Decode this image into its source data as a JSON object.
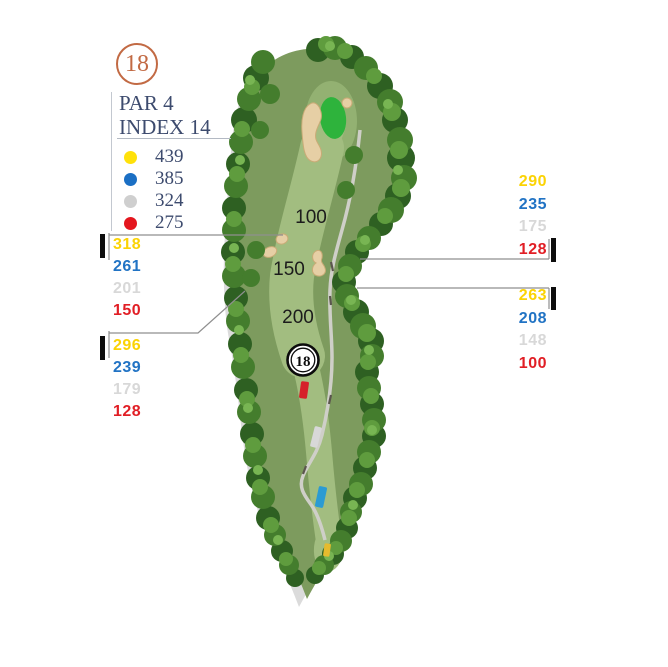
{
  "hole_badge": {
    "number": "18",
    "ring_color": "#c26a44"
  },
  "header": {
    "par_label": "PAR 4",
    "index_label": "INDEX 14",
    "text_color": "#3d4b6e"
  },
  "legend": {
    "rows": [
      {
        "tee": "yellow",
        "color": "#ffe10a",
        "yards": "439"
      },
      {
        "tee": "blue",
        "color": "#1b6fc4",
        "yards": "385"
      },
      {
        "tee": "white",
        "color": "#cfcfcf",
        "yards": "324"
      },
      {
        "tee": "red",
        "color": "#e4161e",
        "yards": "275"
      }
    ]
  },
  "yardages": {
    "left_upper": {
      "values": [
        {
          "tee": "yellow",
          "color": "#fbd304",
          "yards": "318"
        },
        {
          "tee": "blue",
          "color": "#2173c4",
          "yards": "261"
        },
        {
          "tee": "white",
          "color": "#d8d8d8",
          "yards": "201"
        },
        {
          "tee": "red",
          "color": "#e11e25",
          "yards": "150"
        }
      ]
    },
    "left_lower": {
      "values": [
        {
          "tee": "yellow",
          "color": "#fbd304",
          "yards": "296"
        },
        {
          "tee": "blue",
          "color": "#2173c4",
          "yards": "239"
        },
        {
          "tee": "white",
          "color": "#d8d8d8",
          "yards": "179"
        },
        {
          "tee": "red",
          "color": "#e11e25",
          "yards": "128"
        }
      ]
    },
    "right_upper": {
      "values": [
        {
          "tee": "yellow",
          "color": "#fbd304",
          "yards": "290"
        },
        {
          "tee": "blue",
          "color": "#2173c4",
          "yards": "235"
        },
        {
          "tee": "white",
          "color": "#d8d8d8",
          "yards": "175"
        },
        {
          "tee": "red",
          "color": "#e11e25",
          "yards": "128"
        }
      ]
    },
    "right_lower": {
      "values": [
        {
          "tee": "yellow",
          "color": "#fbd304",
          "yards": "263"
        },
        {
          "tee": "blue",
          "color": "#2173c4",
          "yards": "208"
        },
        {
          "tee": "white",
          "color": "#d8d8d8",
          "yards": "148"
        },
        {
          "tee": "red",
          "color": "#e11e25",
          "yards": "100"
        }
      ]
    }
  },
  "course": {
    "distance_markers": [
      {
        "label": "100"
      },
      {
        "label": "150"
      },
      {
        "label": "200"
      }
    ],
    "hole_marker": "18",
    "tee_boxes": [
      {
        "name": "red-tee",
        "color": "#d6202a"
      },
      {
        "name": "white-tee",
        "color": "#d8d8d8"
      },
      {
        "name": "blue-tee",
        "color": "#2b9bd3"
      },
      {
        "name": "yellow-tee",
        "color": "#e6bb2e"
      }
    ]
  }
}
